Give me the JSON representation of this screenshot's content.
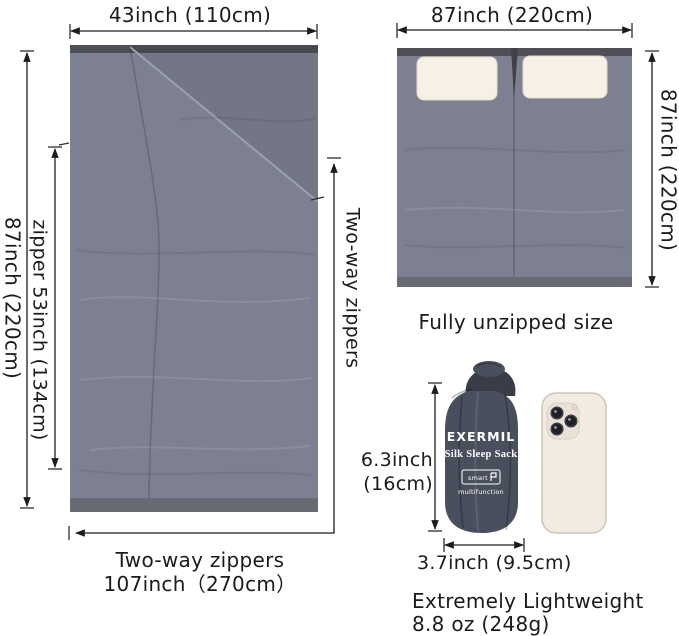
{
  "colors": {
    "background": "#ffffff",
    "fabric": "#7d8090",
    "fabric_top_edge": "#4e4f57",
    "fabric_bottom_edge": "#686a74",
    "fold_shade": "rgba(0,0,0,0.08)",
    "pillow": "#f6f0e6",
    "sack_body": "#4a4f5d",
    "sack_dark": "#383d49",
    "phone_body": "#f2ebe2",
    "phone_camera": "#e9e1d5",
    "lens": "#1f2025",
    "brand_text": "#ffffff",
    "dim_line": "#1c1c1c"
  },
  "flat_sack": {
    "width_label": "43inch (110cm)",
    "height_label": "87inch (220cm)",
    "zipper_label": "zipper 53inch (134cm)",
    "side_label": "Two-way zippers",
    "bottom_caption_line1": "Two-way zippers",
    "bottom_caption_line2": "107inch（270cm）"
  },
  "unzipped_sack": {
    "width_label": "87inch (220cm)",
    "height_label": "87inch (220cm)",
    "caption": "Fully unzipped size"
  },
  "stuff_sack": {
    "brand": "EXERMIL",
    "product_name": "Silk Sleep Sack",
    "logo_text": "smart",
    "logo_subtext": "multifunction",
    "height_label_line1": "6.3inch",
    "height_label_line2": "(16cm)",
    "width_label": "3.7inch (9.5cm)",
    "caption_line1": "Extremely Lightweight",
    "caption_line2": "8.8 oz (248g)"
  }
}
